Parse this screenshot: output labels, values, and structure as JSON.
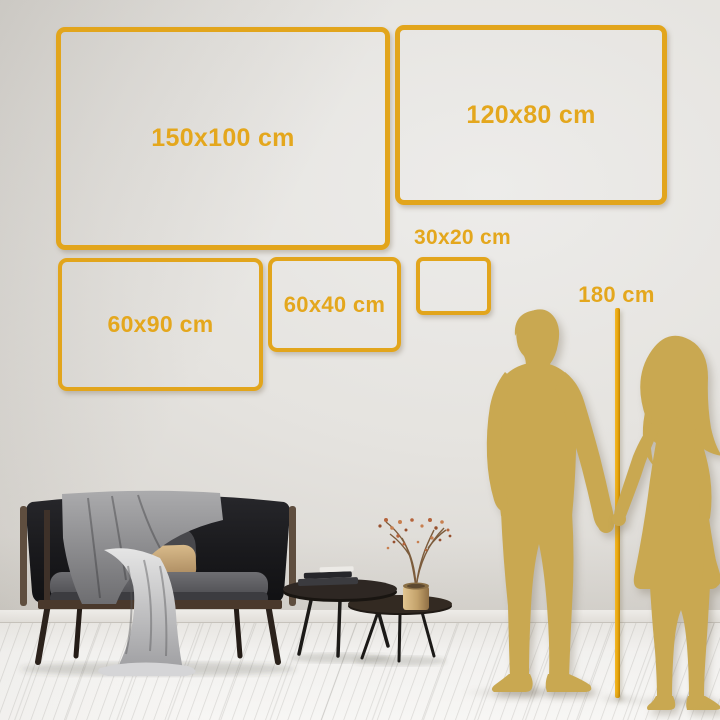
{
  "sizes": {
    "items": [
      {
        "label": "150x100 cm"
      },
      {
        "label": "120x80 cm"
      },
      {
        "label": "60x90 cm"
      },
      {
        "label": "60x40 cm"
      },
      {
        "label": "30x20 cm"
      }
    ]
  },
  "ruler": {
    "label": "180 cm"
  },
  "colors": {
    "frame_gold": "#e2a51c",
    "text_gold": "#e4a71d",
    "silhouette_gold": "#c9a851",
    "pole_gold": "#e7a70e"
  }
}
